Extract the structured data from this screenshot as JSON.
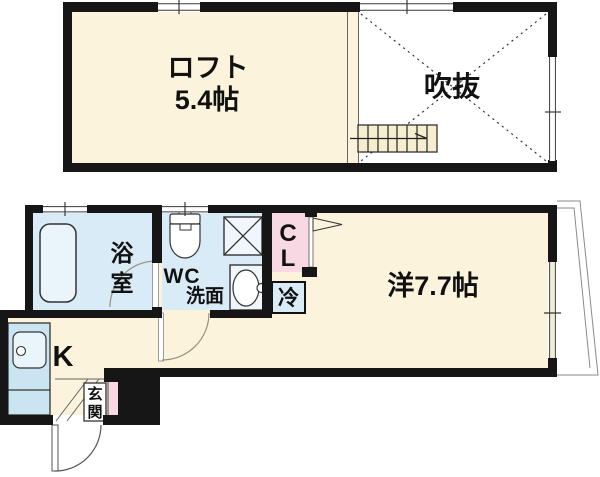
{
  "floorplan": {
    "upper_floor": {
      "loft_label": "ロフト",
      "loft_size": "5.4帖",
      "void_label": "吹抜"
    },
    "lower_floor": {
      "bathroom_char_top": "浴",
      "bathroom_char_bottom": "室",
      "wc_label": "WC",
      "washroom_label": "洗面",
      "closet_char_top": "C",
      "closet_char_bottom": "L",
      "fridge_label": "冷",
      "main_room_label": "洋7.7帖",
      "kitchen_label": "K",
      "entrance_char_top": "玄",
      "entrance_char_bottom": "関"
    },
    "colors": {
      "room_cream": "#FBF3DB",
      "wet_area_blue": "#D9EBF6",
      "closet_pink": "#F8D8E3",
      "wall_black": "#161616",
      "fixture_fill": "#EAF4FB"
    }
  }
}
